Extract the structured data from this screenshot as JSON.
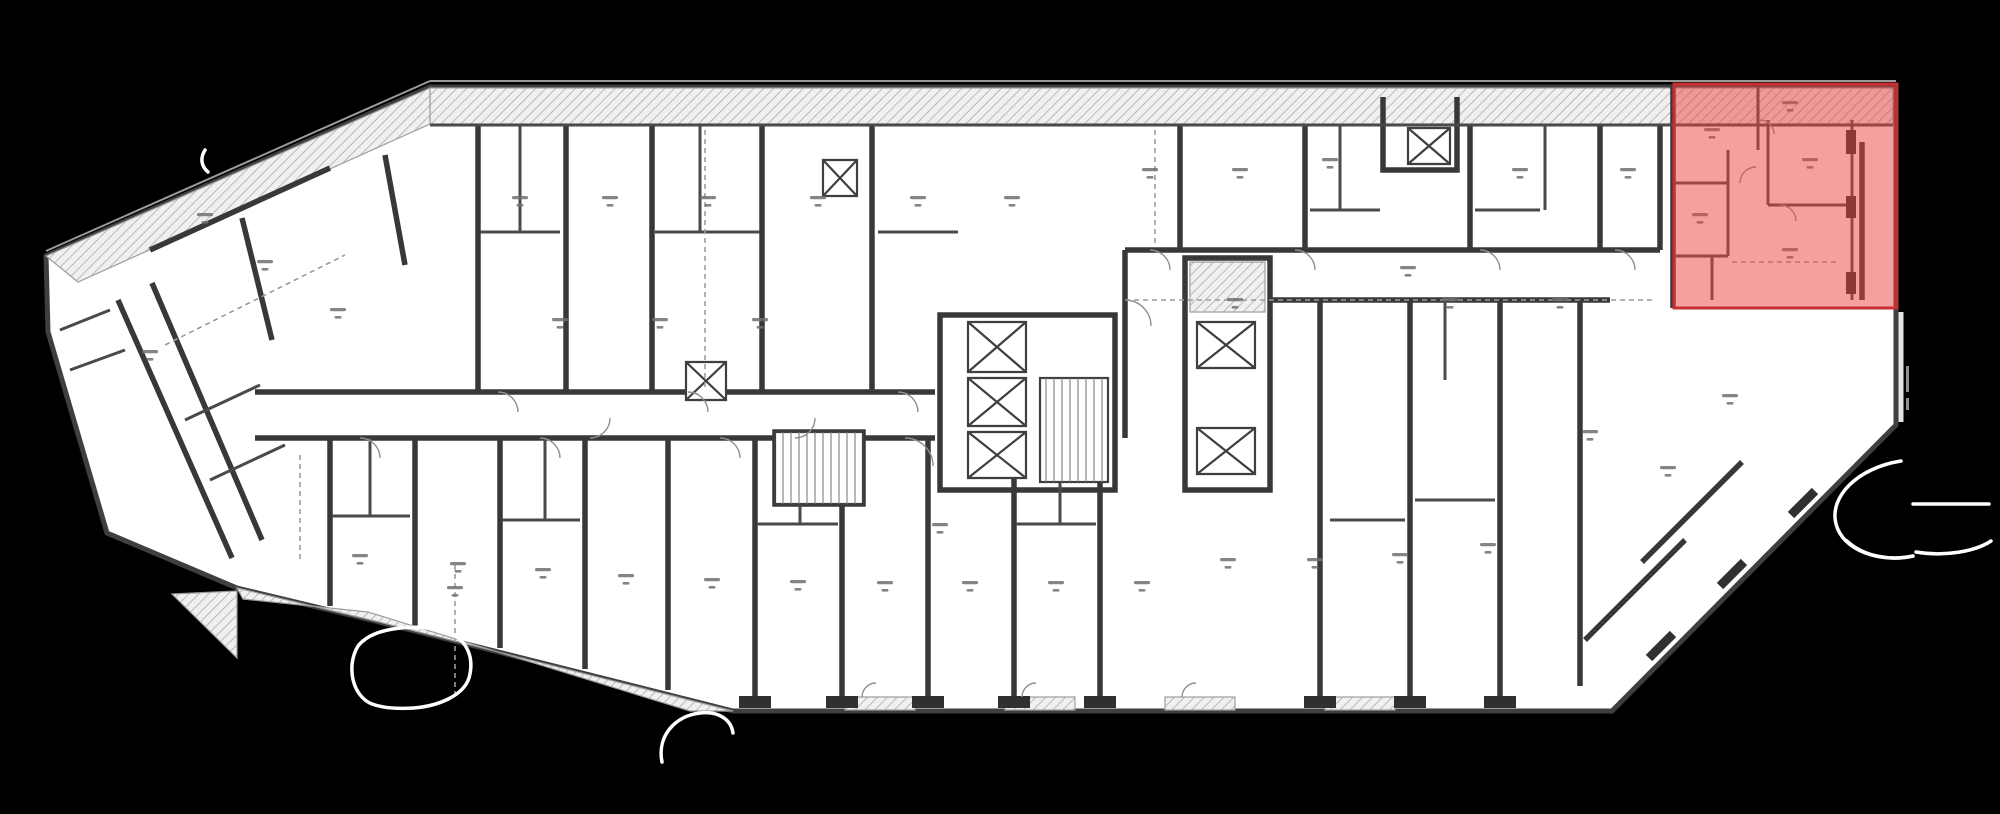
{
  "canvas": {
    "width": 2000,
    "height": 814,
    "background_color": "#000000"
  },
  "plan": {
    "fill_color": "#ffffff",
    "wall_color": "#383838",
    "partition_color": "#4a4a4a",
    "hatch_line_color": "#b9b9b9",
    "dash_color": "#9c9c9c",
    "door_arc_color": "#8f8f8f",
    "label_mark_color": "#707070",
    "outline_points": "46,256 48,332 107,533 237,588 375,621 733,711 1612,711 1896,425 1896,87 430,87",
    "label_marks": [
      [
        205,
        215
      ],
      [
        265,
        262
      ],
      [
        338,
        310
      ],
      [
        150,
        352
      ],
      [
        520,
        198
      ],
      [
        610,
        198
      ],
      [
        708,
        198
      ],
      [
        818,
        198
      ],
      [
        918,
        198
      ],
      [
        1012,
        198
      ],
      [
        560,
        320
      ],
      [
        660,
        320
      ],
      [
        760,
        320
      ],
      [
        1150,
        170
      ],
      [
        1240,
        170
      ],
      [
        1330,
        160
      ],
      [
        1520,
        170
      ],
      [
        1628,
        170
      ],
      [
        1235,
        300
      ],
      [
        1450,
        300
      ],
      [
        1560,
        300
      ],
      [
        1712,
        130
      ],
      [
        1810,
        160
      ],
      [
        1790,
        250
      ],
      [
        1700,
        215
      ],
      [
        1790,
        103
      ],
      [
        455,
        588
      ],
      [
        940,
        525
      ],
      [
        1408,
        268
      ],
      [
        360,
        556
      ],
      [
        458,
        564
      ],
      [
        543,
        570
      ],
      [
        626,
        576
      ],
      [
        712,
        580
      ],
      [
        798,
        582
      ],
      [
        885,
        583
      ],
      [
        970,
        583
      ],
      [
        1056,
        583
      ],
      [
        1142,
        583
      ],
      [
        1228,
        560
      ],
      [
        1315,
        560
      ],
      [
        1400,
        555
      ],
      [
        1488,
        545
      ],
      [
        1590,
        432
      ],
      [
        1668,
        468
      ],
      [
        1730,
        396
      ]
    ],
    "revision_clouds": [
      "M372 704 C352 696 346 666 358 646 C372 628 410 624 440 630 C470 637 474 660 469 678 C463 696 438 706 414 708 C398 709 383 708 372 704",
      "M662 762 C657 737 674 716 700 713 C718 711 731 719 733 733",
      "M1901 461 C1857 468 1829 497 1836 524 C1843 551 1880 563 1913 556",
      "M1847 541 C1864 557 1892 561 1913 556",
      "M1913 504 L1989 504",
      "M1916 552 C1946 557 1976 551 1991 541",
      "M205 150 C200 158 201 166 208 172"
    ],
    "cloud_color": "#ffffff"
  },
  "highlight": {
    "shape": "rectangle",
    "x": 1674,
    "y": 84,
    "width": 223,
    "height": 224,
    "fill": "#ee4040",
    "fill_opacity": 0.5,
    "stroke": "#c43030",
    "stroke_width": 3
  }
}
